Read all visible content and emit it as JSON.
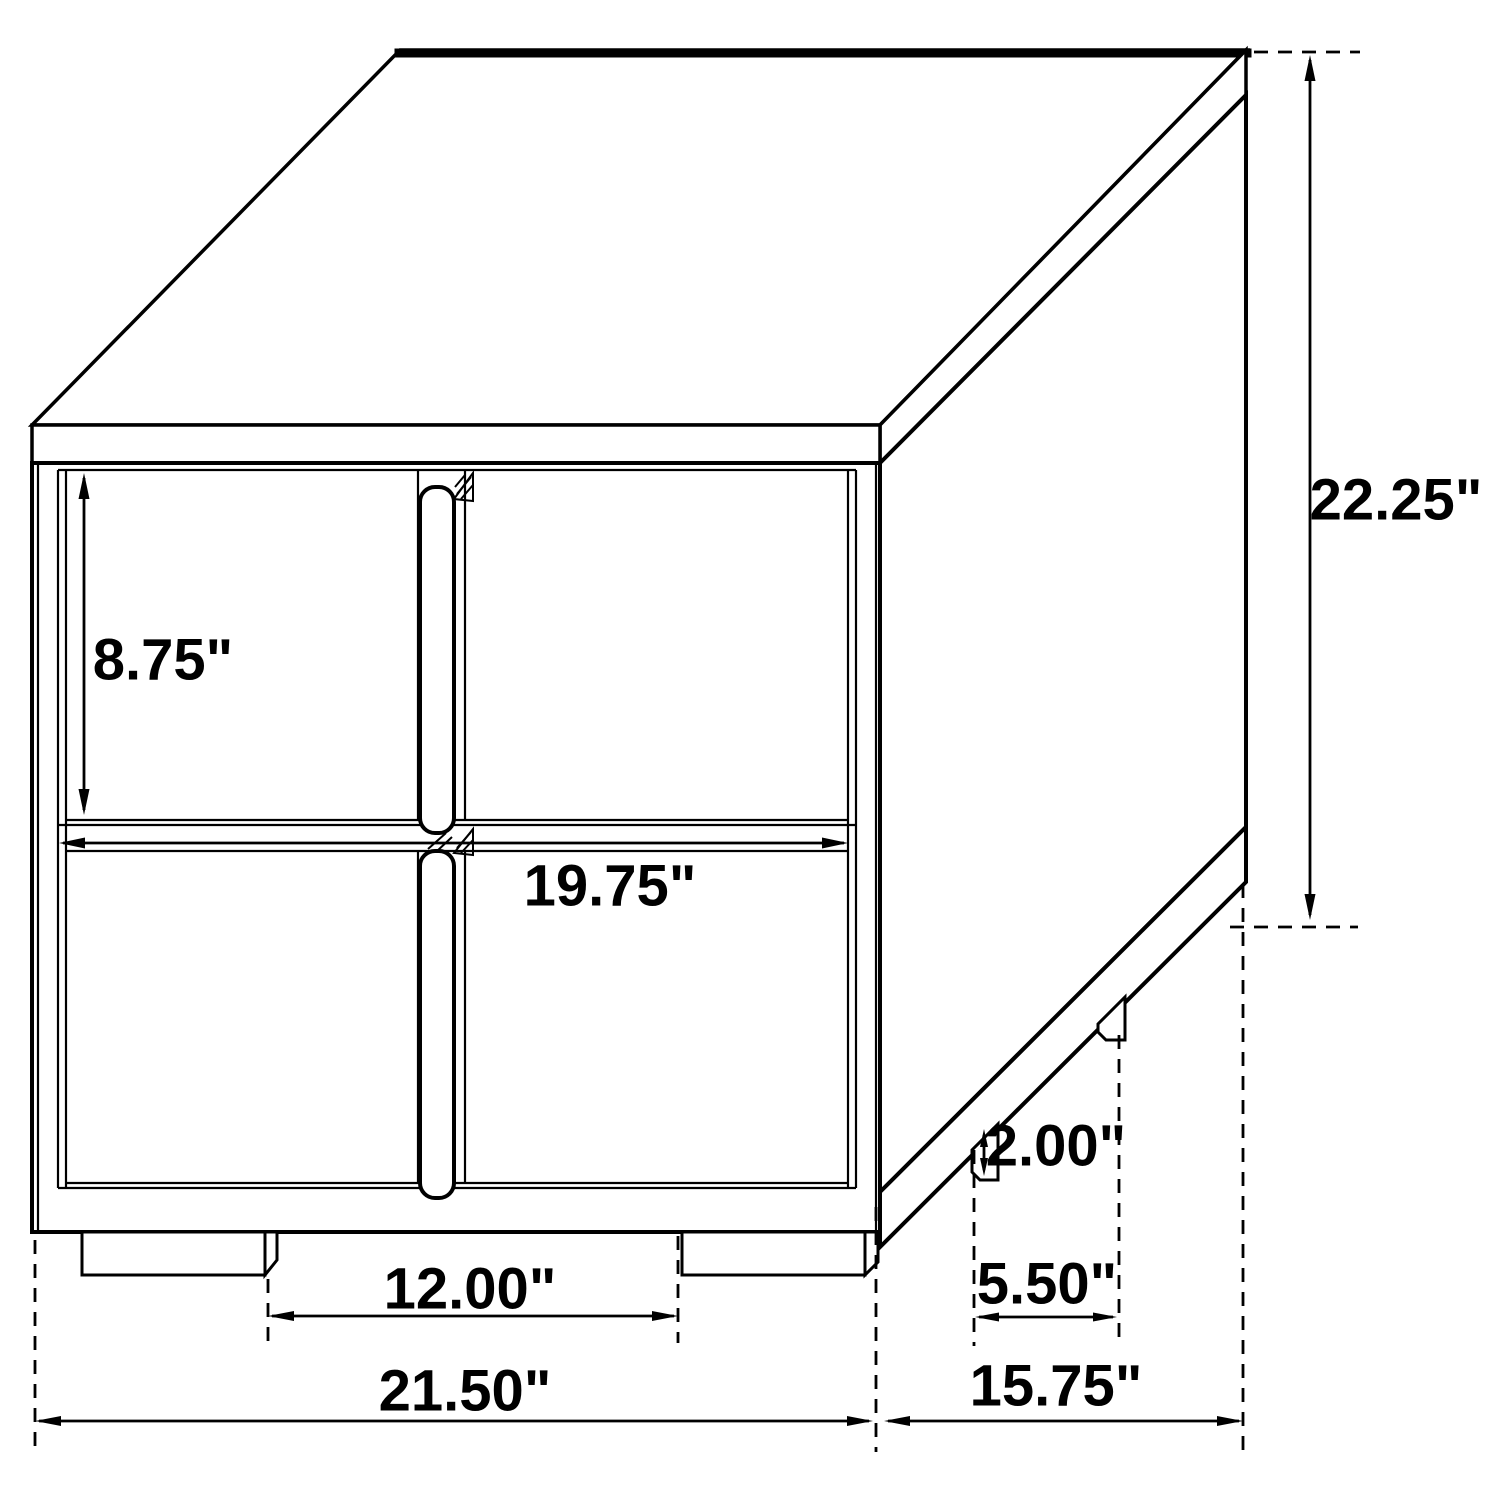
{
  "diagram": {
    "type": "furniture-dimension-drawing",
    "item": "two-drawer nightstand, perspective view",
    "unit": "inches",
    "background_color": "#ffffff",
    "line_color": "#000000",
    "dimensions": {
      "overall_height": "22.25\"",
      "drawer_face_height": "8.75\"",
      "drawer_width": "19.75\"",
      "foot_height": "2.00\"",
      "side_foot_spacing": "5.50\"",
      "front_foot_spacing": "12.00\"",
      "overall_width": "21.50\"",
      "overall_depth": "15.75\""
    }
  }
}
